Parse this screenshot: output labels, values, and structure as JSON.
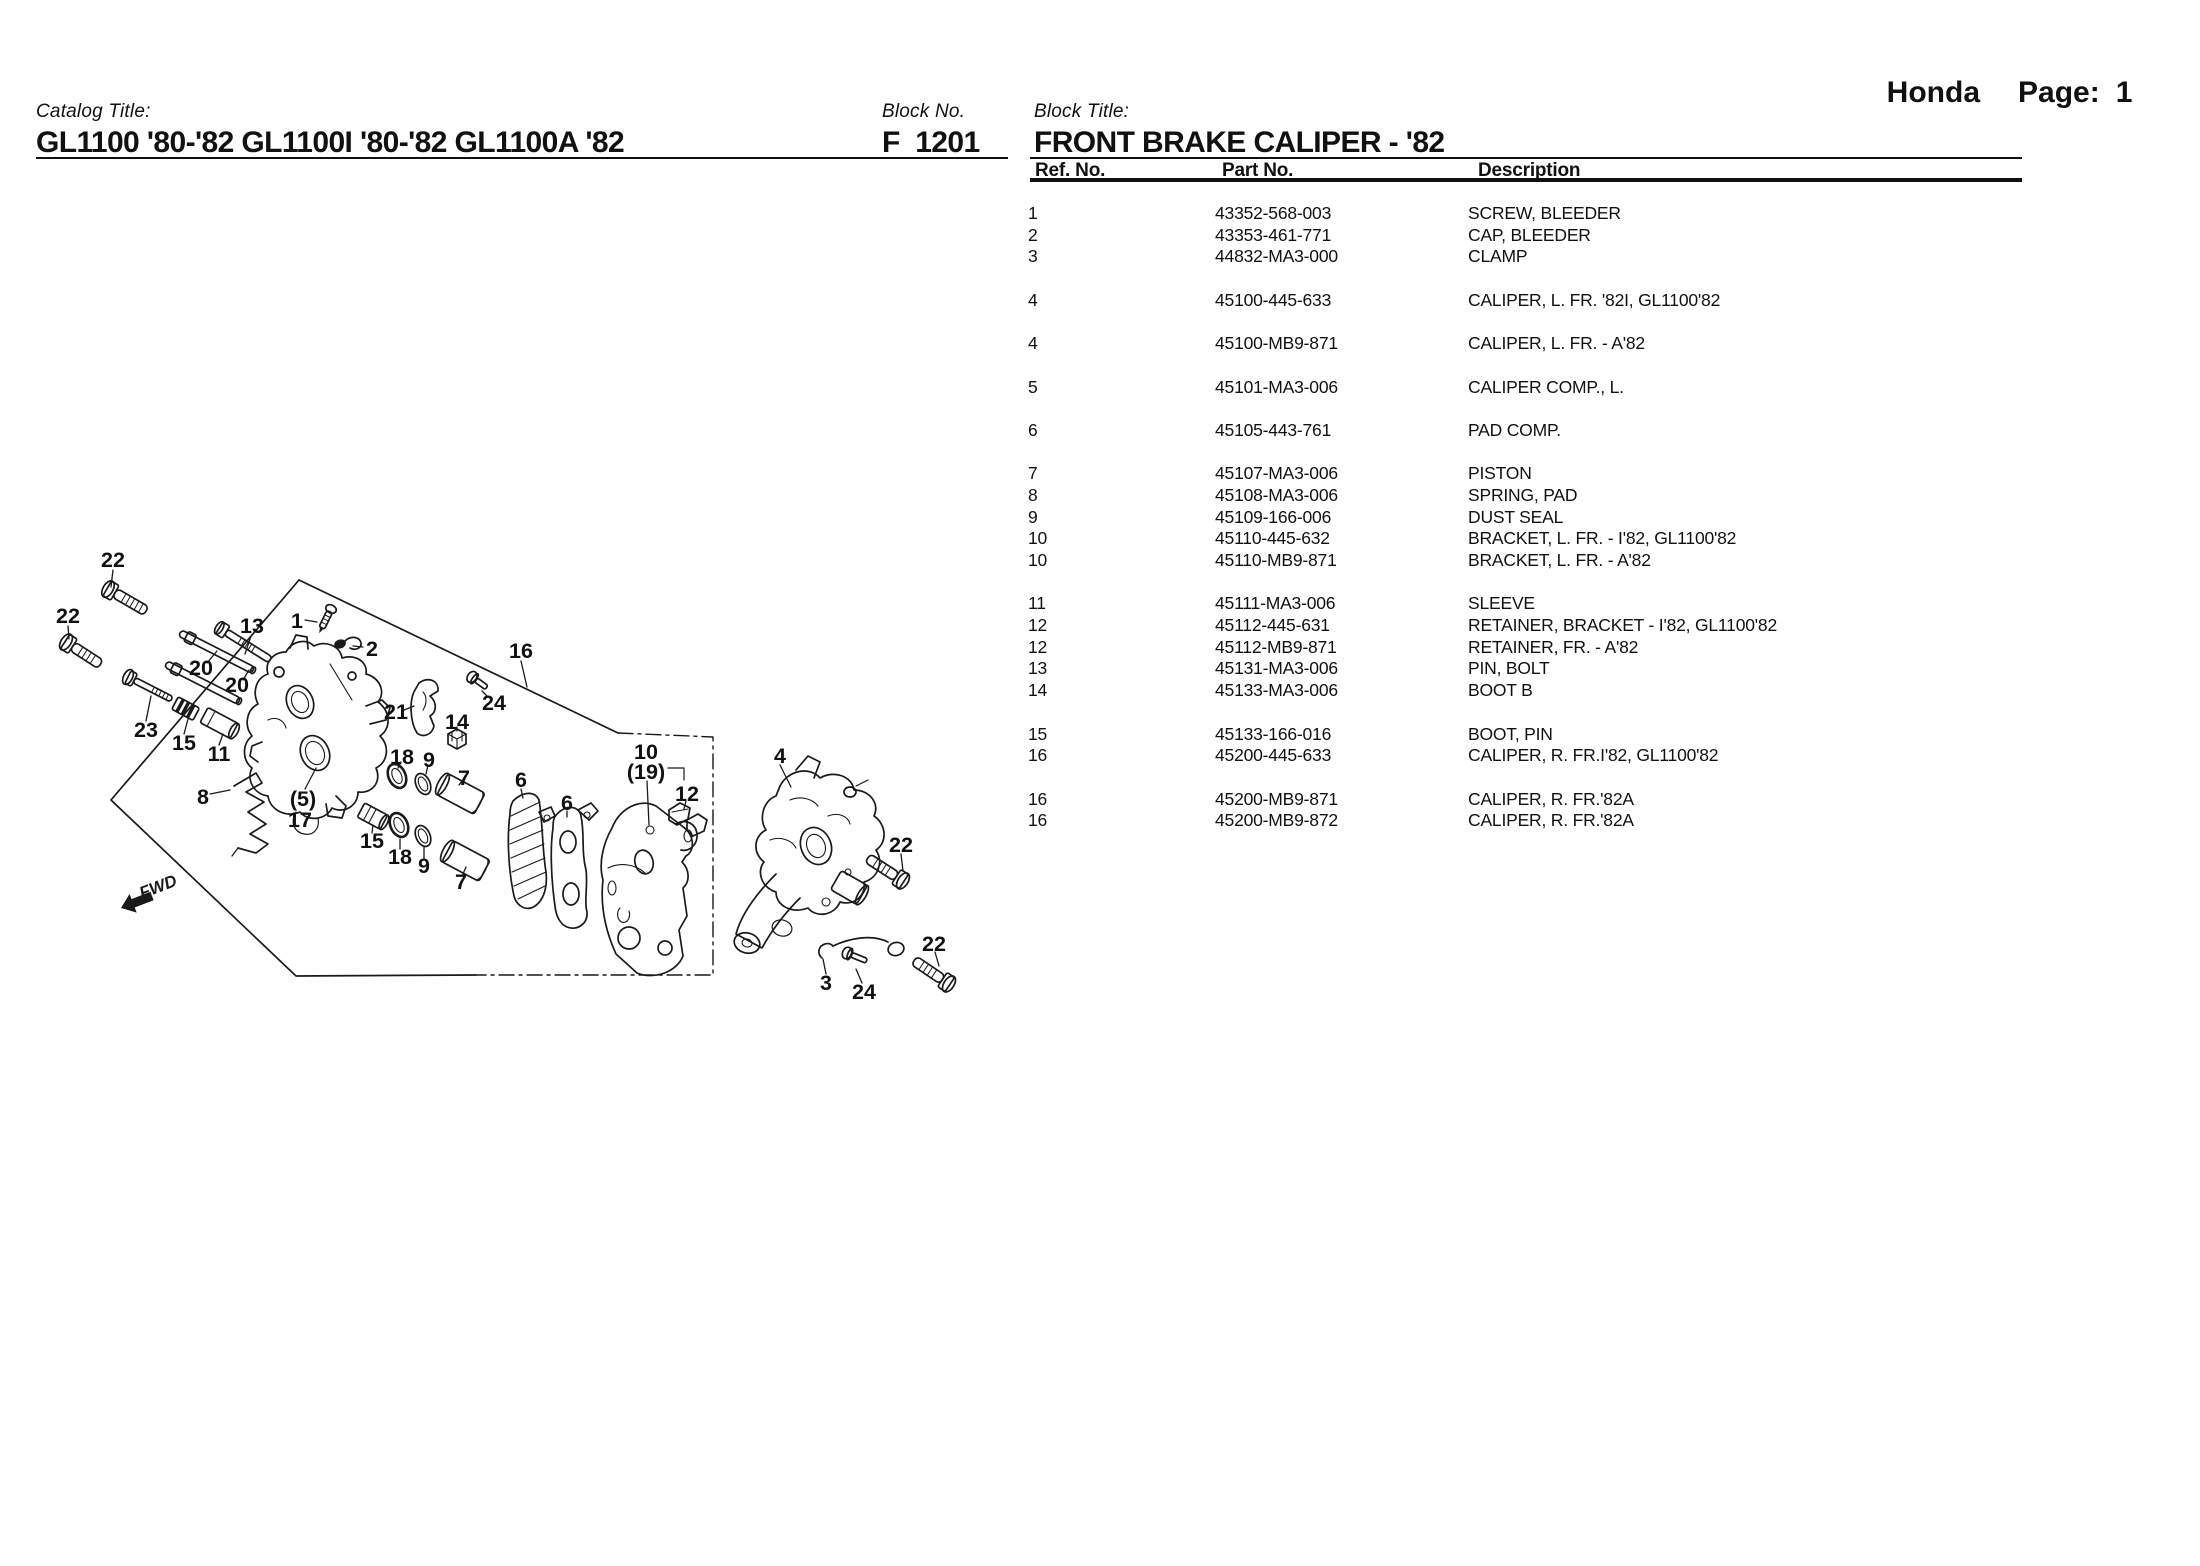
{
  "colors": {
    "ink": "#1a1a1a"
  },
  "header": {
    "brand": "Honda",
    "page_label": "Page:",
    "page_number": "1"
  },
  "catalog": {
    "label": "Catalog Title:",
    "title": "GL1100 '80-'82 GL1100I '80-'82 GL1100A '82"
  },
  "block": {
    "no_label": "Block No.",
    "no": "F  1201",
    "title_label": "Block Title:",
    "title": "FRONT BRAKE CALIPER - '82"
  },
  "table": {
    "columns": [
      "Ref. No.",
      "Part No.",
      "Description"
    ],
    "rows": [
      {
        "ref": "1",
        "part": "43352-568-003",
        "desc": "SCREW, BLEEDER",
        "gap": false
      },
      {
        "ref": "2",
        "part": "43353-461-771",
        "desc": "CAP, BLEEDER",
        "gap": false
      },
      {
        "ref": "3",
        "part": "44832-MA3-000",
        "desc": "CLAMP",
        "gap": false
      },
      {
        "ref": "4",
        "part": "45100-445-633",
        "desc": "CALIPER, L. FR. '82I, GL1100'82",
        "gap": true
      },
      {
        "ref": "4",
        "part": "45100-MB9-871",
        "desc": "CALIPER, L. FR. - A'82",
        "gap": true
      },
      {
        "ref": "5",
        "part": "45101-MA3-006",
        "desc": "CALIPER COMP., L.",
        "gap": true
      },
      {
        "ref": "6",
        "part": "45105-443-761",
        "desc": "PAD COMP.",
        "gap": true
      },
      {
        "ref": "7",
        "part": "45107-MA3-006",
        "desc": "PISTON",
        "gap": true
      },
      {
        "ref": "8",
        "part": "45108-MA3-006",
        "desc": "SPRING, PAD",
        "gap": false
      },
      {
        "ref": "9",
        "part": "45109-166-006",
        "desc": "DUST SEAL",
        "gap": false
      },
      {
        "ref": "10",
        "part": "45110-445-632",
        "desc": "BRACKET, L. FR. - I'82, GL1100'82",
        "gap": false
      },
      {
        "ref": "10",
        "part": "45110-MB9-871",
        "desc": "BRACKET, L. FR. - A'82",
        "gap": false
      },
      {
        "ref": "11",
        "part": "45111-MA3-006",
        "desc": "SLEEVE",
        "gap": true
      },
      {
        "ref": "12",
        "part": "45112-445-631",
        "desc": "RETAINER, BRACKET - I'82, GL1100'82",
        "gap": false
      },
      {
        "ref": "12",
        "part": "45112-MB9-871",
        "desc": "RETAINER, FR. - A'82",
        "gap": false
      },
      {
        "ref": "13",
        "part": "45131-MA3-006",
        "desc": "PIN, BOLT",
        "gap": false
      },
      {
        "ref": "14",
        "part": "45133-MA3-006",
        "desc": "BOOT B",
        "gap": false
      },
      {
        "ref": "15",
        "part": "45133-166-016",
        "desc": "BOOT, PIN",
        "gap": true
      },
      {
        "ref": "16",
        "part": "45200-445-633",
        "desc": "CALIPER, R. FR.I'82, GL1100'82",
        "gap": false
      },
      {
        "ref": "16",
        "part": "45200-MB9-871",
        "desc": "CALIPER, R. FR.'82A",
        "gap": true
      },
      {
        "ref": "16",
        "part": "45200-MB9-872",
        "desc": "CALIPER, R. FR.'82A",
        "gap": false
      }
    ]
  },
  "diagram": {
    "fwd_label": "FWD",
    "labels": [
      {
        "t": "22",
        "x": 113,
        "y": 560,
        "l": [
          113,
          570,
          111,
          587
        ]
      },
      {
        "t": "22",
        "x": 68,
        "y": 616,
        "l": [
          68,
          626,
          69,
          639
        ]
      },
      {
        "t": "13",
        "x": 252,
        "y": 626,
        "l": [
          251,
          636,
          245,
          654
        ]
      },
      {
        "t": "1",
        "x": 297,
        "y": 621,
        "l": [
          305,
          620,
          317,
          622
        ]
      },
      {
        "t": "2",
        "x": 372,
        "y": 649,
        "l": [
          363,
          647,
          353,
          646
        ]
      },
      {
        "t": "16",
        "x": 521,
        "y": 651,
        "l": [
          521,
          661,
          527,
          687
        ]
      },
      {
        "t": "20",
        "x": 201,
        "y": 668,
        "l": [
          207,
          663,
          217,
          651
        ]
      },
      {
        "t": "20",
        "x": 237,
        "y": 685,
        "l": [
          243,
          680,
          249,
          670
        ]
      },
      {
        "t": "23",
        "x": 146,
        "y": 730,
        "l": [
          146,
          721,
          151,
          696
        ]
      },
      {
        "t": "15",
        "x": 184,
        "y": 743,
        "l": [
          184,
          734,
          188,
          719
        ]
      },
      {
        "t": "11",
        "x": 219,
        "y": 754,
        "l": [
          219,
          745,
          223,
          734
        ]
      },
      {
        "t": "21",
        "x": 396,
        "y": 712,
        "l": [
          404,
          710,
          414,
          706
        ]
      },
      {
        "t": "24",
        "x": 494,
        "y": 703,
        "l": [
          488,
          697,
          482,
          691
        ]
      },
      {
        "t": "14",
        "x": 457,
        "y": 722,
        "l": [
          457,
          727,
          457,
          731
        ]
      },
      {
        "t": "18",
        "x": 402,
        "y": 757,
        "l": [
          401,
          762,
          398,
          768
        ]
      },
      {
        "t": "9",
        "x": 429,
        "y": 760,
        "l": [
          428,
          765,
          426,
          774
        ]
      },
      {
        "t": "7",
        "x": 464,
        "y": 778,
        "l": [
          462,
          781,
          459,
          785
        ]
      },
      {
        "t": "6",
        "x": 521,
        "y": 780,
        "l": [
          521,
          789,
          523,
          798
        ]
      },
      {
        "t": "6",
        "x": 567,
        "y": 803,
        "l": [
          567,
          811,
          567,
          817
        ]
      },
      {
        "t": "8",
        "x": 203,
        "y": 797,
        "l": [
          210,
          794,
          230,
          790
        ]
      },
      {
        "t": "(5)",
        "x": 303,
        "y": 799,
        "l": [
          305,
          789,
          316,
          768
        ]
      },
      {
        "t": "17",
        "x": 300,
        "y": 820
      },
      {
        "t": "15",
        "x": 372,
        "y": 841,
        "l": [
          372,
          833,
          373,
          825
        ]
      },
      {
        "t": "18",
        "x": 400,
        "y": 857,
        "l": [
          400,
          849,
          400,
          839
        ]
      },
      {
        "t": "9",
        "x": 424,
        "y": 866,
        "l": [
          424,
          858,
          424,
          847
        ]
      },
      {
        "t": "7",
        "x": 461,
        "y": 882,
        "l": [
          463,
          874,
          466,
          867
        ]
      },
      {
        "t": "10",
        "x": 646,
        "y": 752
      },
      {
        "t": "(19)",
        "x": 646,
        "y": 772,
        "l": [
          647,
          781,
          649,
          825
        ]
      },
      {
        "t": "12",
        "x": 687,
        "y": 794,
        "l": [
          686,
          801,
          684,
          809
        ]
      },
      {
        "t": "4",
        "x": 780,
        "y": 756,
        "l": [
          780,
          765,
          791,
          787
        ]
      },
      {
        "t": "22",
        "x": 901,
        "y": 845,
        "l": [
          901,
          854,
          903,
          871
        ]
      },
      {
        "t": "22",
        "x": 934,
        "y": 944,
        "l": [
          935,
          952,
          939,
          966
        ]
      },
      {
        "t": "3",
        "x": 826,
        "y": 983,
        "l": [
          826,
          974,
          823,
          959
        ]
      },
      {
        "t": "24",
        "x": 864,
        "y": 992,
        "l": [
          862,
          983,
          856,
          969
        ]
      }
    ]
  }
}
